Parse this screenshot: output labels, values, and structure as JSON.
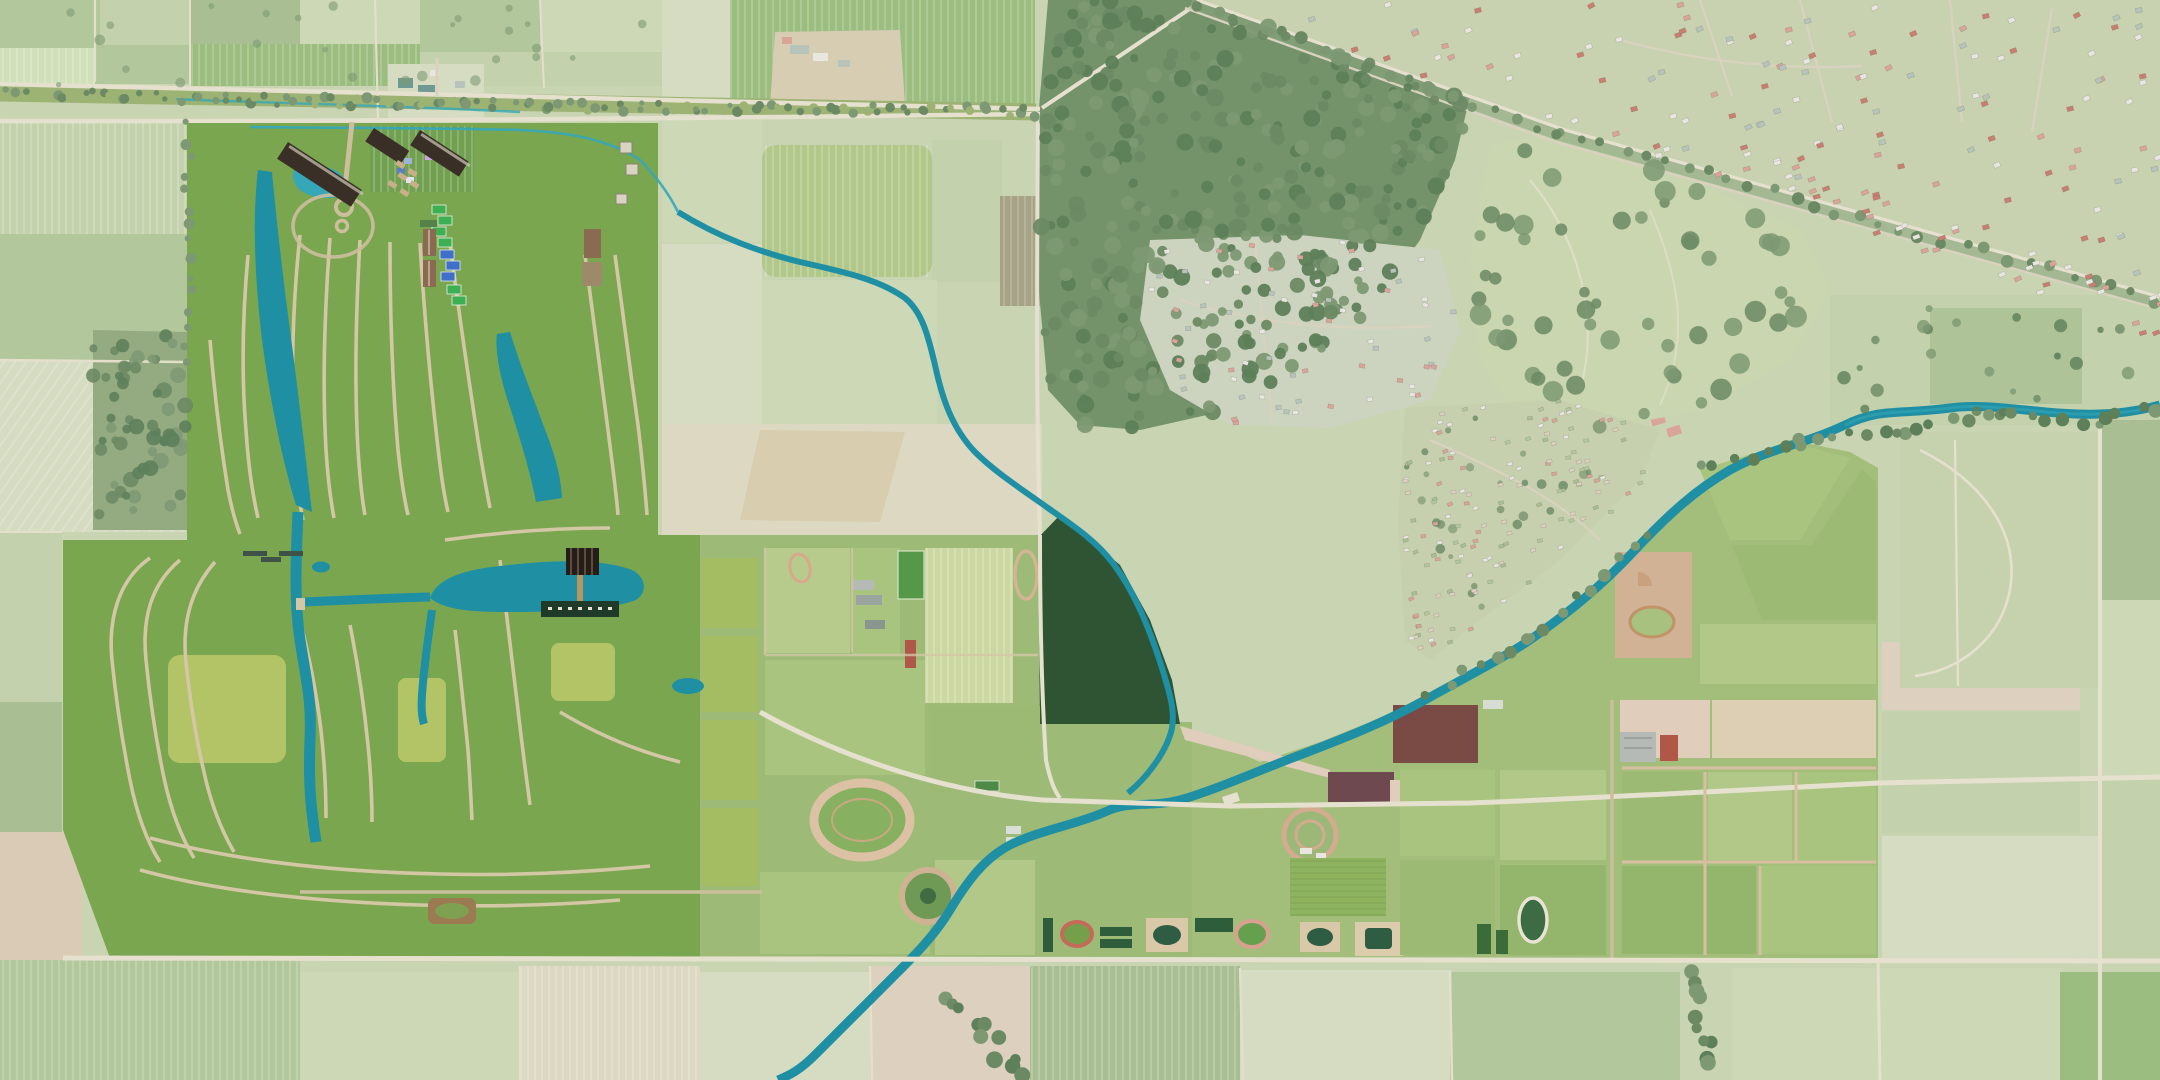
{
  "meta": {
    "title": "Aerial photo composite: holiday-park and farmland masterplan rendered onto existing satellite farmland, village and forest",
    "view": "top-down satellite",
    "width_px": 2160,
    "height_px": 1080
  },
  "palette": {
    "base": "#c9d4b2",
    "m1": "#c3d2ac",
    "m2": "#b3c79c",
    "m3": "#cfe0ba",
    "m4": "#a9bf93",
    "m5": "#ccd8b6",
    "m6": "#d6dcc2",
    "m7": "#dcd8c2",
    "m8": "#9cbd80",
    "plow1": "#ddd0be",
    "plow2": "#e0cdbb",
    "plow3": "#d9cbb5",
    "dirt": "#d6cdb2",
    "sand": "#d8cdae",
    "road": "#e6e1cf",
    "road2": "#d8d2be",
    "scrub": "#9db374",
    "mforest1": "#74936b",
    "mforest2": "#6b8a64",
    "mforest3": "#7d9973",
    "mforest4": "#5d7f5a",
    "suburb": "#ccd4c0",
    "golf": "#c9d6b0",
    "allot": "#c6cfae",
    "caravan": "#c6d2ad",
    "roof_pink": "#d9a49a",
    "roof_red": "#c87f72",
    "roof_white": "#e8e6df",
    "roof_gray": "#b7c4bb",
    "roof_teal": "#6f9a93",
    "track_dark": "#4a4440",
    "plots_brown": "#8a7a64",
    "plots_dark": "#6e6052",
    "r_lawn": "#7aa64f",
    "r_lawn2": "#8cb25a",
    "r_yellow": "#b2c465",
    "r_strip": "#a4bd62",
    "r_tree1": "#2f5433",
    "r_tree2": "#3e6b40",
    "r_tree3": "#27492c",
    "r_tree4": "#4d7f45",
    "water": "#1f8fa4",
    "water_lt": "#35a7b8",
    "water_dp": "#17809a",
    "r_path": "#d3c7a5",
    "r_road": "#cdbf9e",
    "cot_white": "#ece9e0",
    "cot_blue": "#7fa4c4",
    "cot_brown": "#8a6046",
    "cot_red": "#a25b48",
    "cot_gray": "#d8d3c6",
    "hotel": "#3a2f26",
    "pavilion": "#241d18",
    "pier": "#b5975f",
    "lodge": "#cfe5bf",
    "lodge2": "#c3dcb0",
    "tennis": "#3faf54",
    "court_blue": "#3f6fc8",
    "track_pink": "#d9a98c",
    "track_red": "#c56a58",
    "track_tan": "#d3b493",
    "barn_green": "#2e5d3c",
    "barn_gray": "#b5bab6",
    "barn_red": "#b05848",
    "manege": "#d9c9a8",
    "arena": "#2f5d44",
    "maroon": "#7a4a44",
    "maroon2": "#6e4a50",
    "crop1": "#ccd8a2",
    "crop2": "#b7cc8c",
    "crop3": "#a9c47e",
    "crop4": "#9cba74",
    "crop5": "#b2c888",
    "crop6": "#93b56c",
    "pitch": "#56984a",
    "pink_tree": "#d8a0b0",
    "camp_brown": "#8a6a50"
  },
  "scene": {
    "regions": [
      {
        "name": "holiday-park-resort",
        "description": "rendered holiday park with tree cover, winding cottage lanes, lakes and canals, left third"
      },
      {
        "name": "entrance-hotel-complex",
        "description": "dark jagged-roof hotel blocks with swimming lagoon at park entrance, top of resort"
      },
      {
        "name": "central-lake-pavilion",
        "description": "elongated central lake with dark pavilion building and pier"
      },
      {
        "name": "lodge-rows",
        "description": "double row of mint-green lodges along southern edge of resort"
      },
      {
        "name": "camping-grids",
        "description": "grids of white tents with brown courts, two locations"
      },
      {
        "name": "tennis-courts",
        "description": "green and blue courts east of entrance"
      },
      {
        "name": "sports-lawns",
        "description": "bright yellow-green event lawns inside resort and strip fields"
      },
      {
        "name": "farm-campus-center",
        "description": "rendered farm fields with running tracks, pitches, barns, equestrian ovals"
      },
      {
        "name": "forest-block",
        "description": "dense dark rendered wood in centre of plan"
      },
      {
        "name": "east-farm-fields",
        "description": "rendered field grid with tan paths, ovals, manege arenas up to eastern tree avenue"
      },
      {
        "name": "meandering-river",
        "description": "teal river entering at right edge, curving southwest and exiting at bottom"
      },
      {
        "name": "existing-village-top-right",
        "description": "muted existing village with pink/red roofed houses along railway corridor"
      },
      {
        "name": "existing-forest",
        "description": "large muted forest mass top right of centre with suburb clearing"
      },
      {
        "name": "allotment-gardens",
        "description": "dense muted allotment plots north of river"
      },
      {
        "name": "caravan-park",
        "description": "muted mobile-home park far right"
      },
      {
        "name": "golf-parkland",
        "description": "pale parkland with tree clumps south of railway"
      },
      {
        "name": "race-track",
        "description": "dark-ringed oval track in far top-right corner"
      },
      {
        "name": "farmland-patchwork",
        "description": "muted pale-green crop fields surrounding the plan"
      },
      {
        "name": "road-corridor",
        "description": "double road with scrub strip crossing upper left, rail diagonal top right"
      }
    ],
    "water_features": [
      "meandering-river",
      "north-stream",
      "roadside-canal",
      "upper-channel-lake",
      "east-banana-lake",
      "central-lake",
      "south-channel",
      "swimming-lagoon",
      "small-ponds"
    ],
    "approximate_counts": {
      "cottages": 700,
      "lodges": 80,
      "village_houses": 330,
      "allotment_plots": 150,
      "caravans": 60
    }
  },
  "generation": {
    "seed": 42,
    "cottage_step": 13,
    "cottage_size": [
      6,
      4.5
    ],
    "cottage_colors": [
      "cot_white",
      "cot_blue",
      "cot_brown",
      "cot_red",
      "cot_gray",
      "cot_blue",
      "cot_white"
    ],
    "resort_tree_count": 520,
    "resort_tree_colors": [
      "r_tree1",
      "r_tree2",
      "r_tree3",
      "r_tree4"
    ],
    "muted_forest_count": 380,
    "muted_forest_colors": [
      "mforest2",
      "mforest3",
      "mforest4"
    ],
    "village_house_colors": [
      "roof_pink",
      "roof_red",
      "roof_white",
      "roof_gray"
    ],
    "suburb_house_colors": [
      "roof_white",
      "roof_gray",
      "roof_pink"
    ],
    "allotment_colors": [
      "m2",
      "roof_white",
      "plow1",
      "roof_pink",
      "m4"
    ],
    "caravan_colors": [
      "roof_white",
      "roof_pink",
      "roof_gray",
      "roof_white"
    ]
  }
}
